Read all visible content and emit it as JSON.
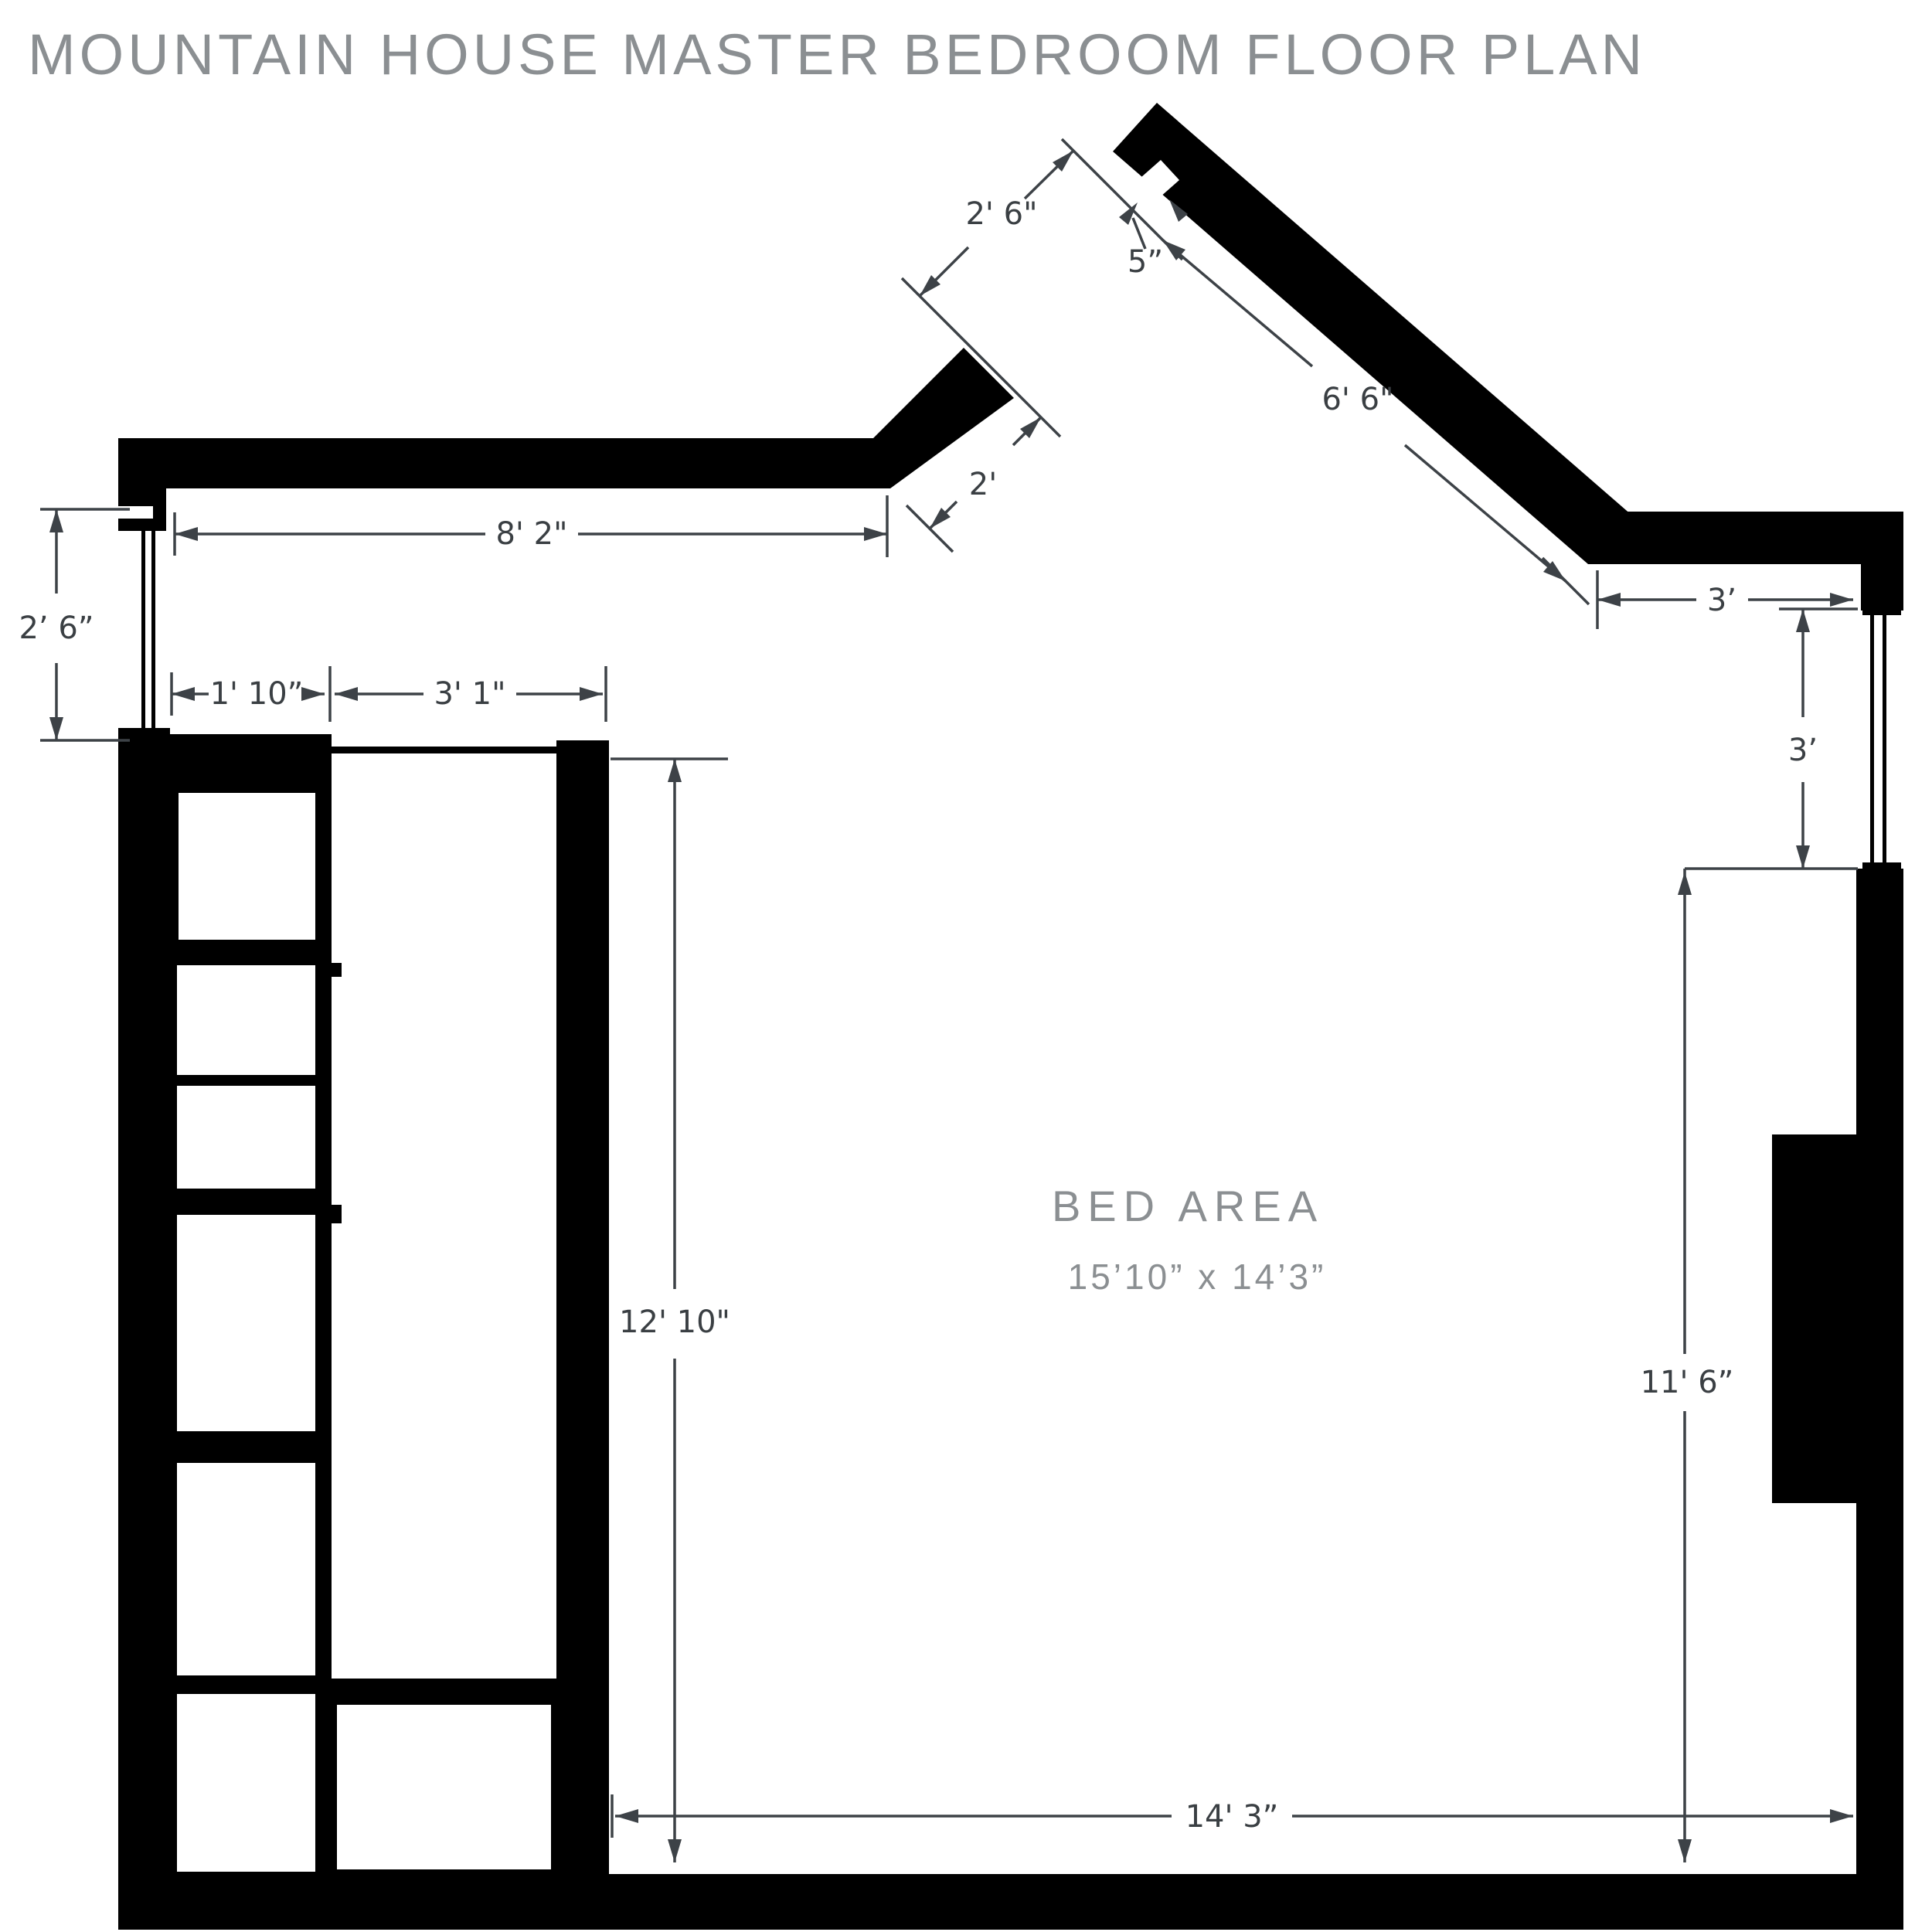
{
  "title": "MOUNTAIN HOUSE MASTER BEDROOM FLOOR PLAN",
  "room": {
    "name": "BED AREA",
    "size": "15’10” x 14’3”"
  },
  "dimensions": {
    "window_left": "2’ 6”",
    "top_wall": "8' 2\"",
    "shelf_depth": "1' 10”",
    "closet_opening": "3' 1\"",
    "closet_height": "12' 10\"",
    "door_opening": "2' 6\"",
    "wall_notch": "5”",
    "diagonal_wall": "6' 6\"",
    "wall_return": "2'",
    "right_top": "3’",
    "window_right": "3’",
    "room_height": "11' 6”",
    "room_width": "14' 3”"
  },
  "colors": {
    "wall": "#000000",
    "dimension": "#3d4247",
    "label_gray": "#8b8f92",
    "background": "#ffffff"
  }
}
